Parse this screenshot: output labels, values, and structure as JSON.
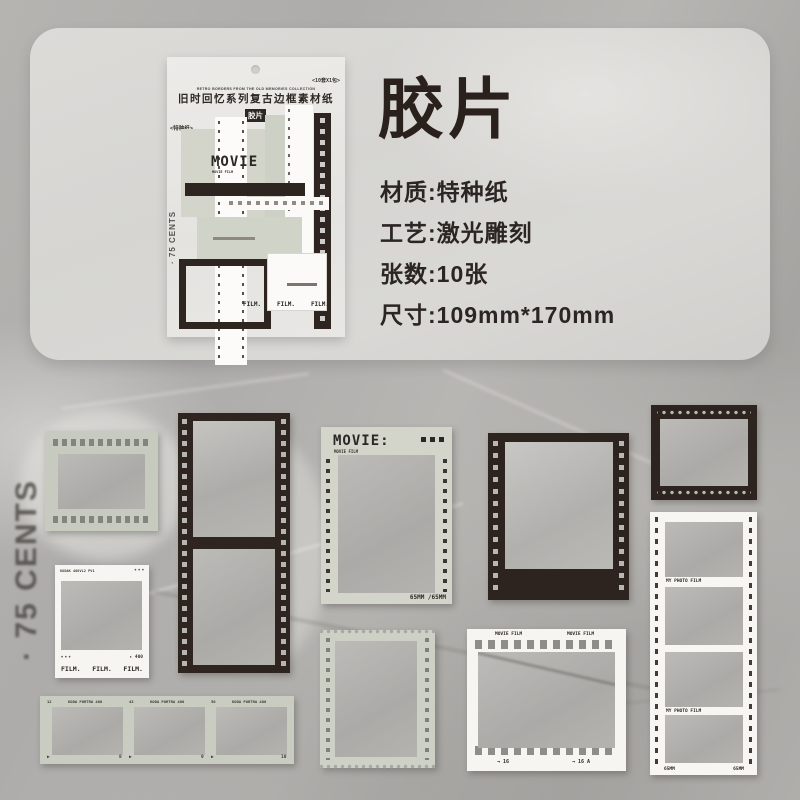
{
  "header": {
    "title": "胶片",
    "specs": [
      "材质:特种纸",
      "工艺:激光雕刻",
      "张数:10张",
      "尺寸:109mm*170mm"
    ]
  },
  "package": {
    "pack_note": "<10套X1包>",
    "english_line": "RETRO BORDERS FROM THE OLD MEMORIES COLLECTION",
    "product_name": "旧时回忆系列复古边框素材纸",
    "badge": "胶片",
    "paper_note": "<特种纸>",
    "cents": "· 75 CENTS",
    "movie_title": "MOVIE",
    "movie_sub": "MOVIE FILM",
    "film_words": [
      "FILM.",
      "FILM.",
      "FILM."
    ]
  },
  "scene": {
    "cents_watermark": "· 75 CENTS",
    "movie_frame": {
      "title": "MOVIE:",
      "sub": "MOVIE FILM",
      "size_note": "65MM /65MM"
    },
    "white_polaroid": {
      "edge_code": "KODAK 400VL2 PV1",
      "dots_right": "• • •",
      "dots_left": "• • •",
      "counter": "▸ 400",
      "film_words": [
        "FILM.",
        "FILM.",
        "FILM."
      ]
    },
    "white_movie_frame": {
      "label_left": "MOVIE FILM",
      "label_right": "MOVIE FILM",
      "mark_left": "→ 16",
      "mark_right": "→ 16 A"
    },
    "photo_strip": {
      "label_1": "MY PHOTO FILM",
      "label_2": "MY PHOTO FILM",
      "size_left": "65MM",
      "size_right": "65MM"
    },
    "negative_strip": {
      "segments": [
        {
          "index": "12",
          "brand": "KODA PORTRA 400",
          "arrow": "▶",
          "number": "8"
        },
        {
          "index": "43",
          "brand": "KODA PORTRA 400",
          "arrow": "▶",
          "number": "9"
        },
        {
          "index": "50",
          "brand": "KODA PORTRA 400",
          "arrow": "▶",
          "number": "10"
        }
      ]
    }
  },
  "colors": {
    "dark": "#2d2420",
    "sage": "#ced2c7",
    "paper_white": "#f7f6f3",
    "ink": "#2a211d",
    "panel": "#d8d7d4",
    "background": "#b0aeab"
  }
}
